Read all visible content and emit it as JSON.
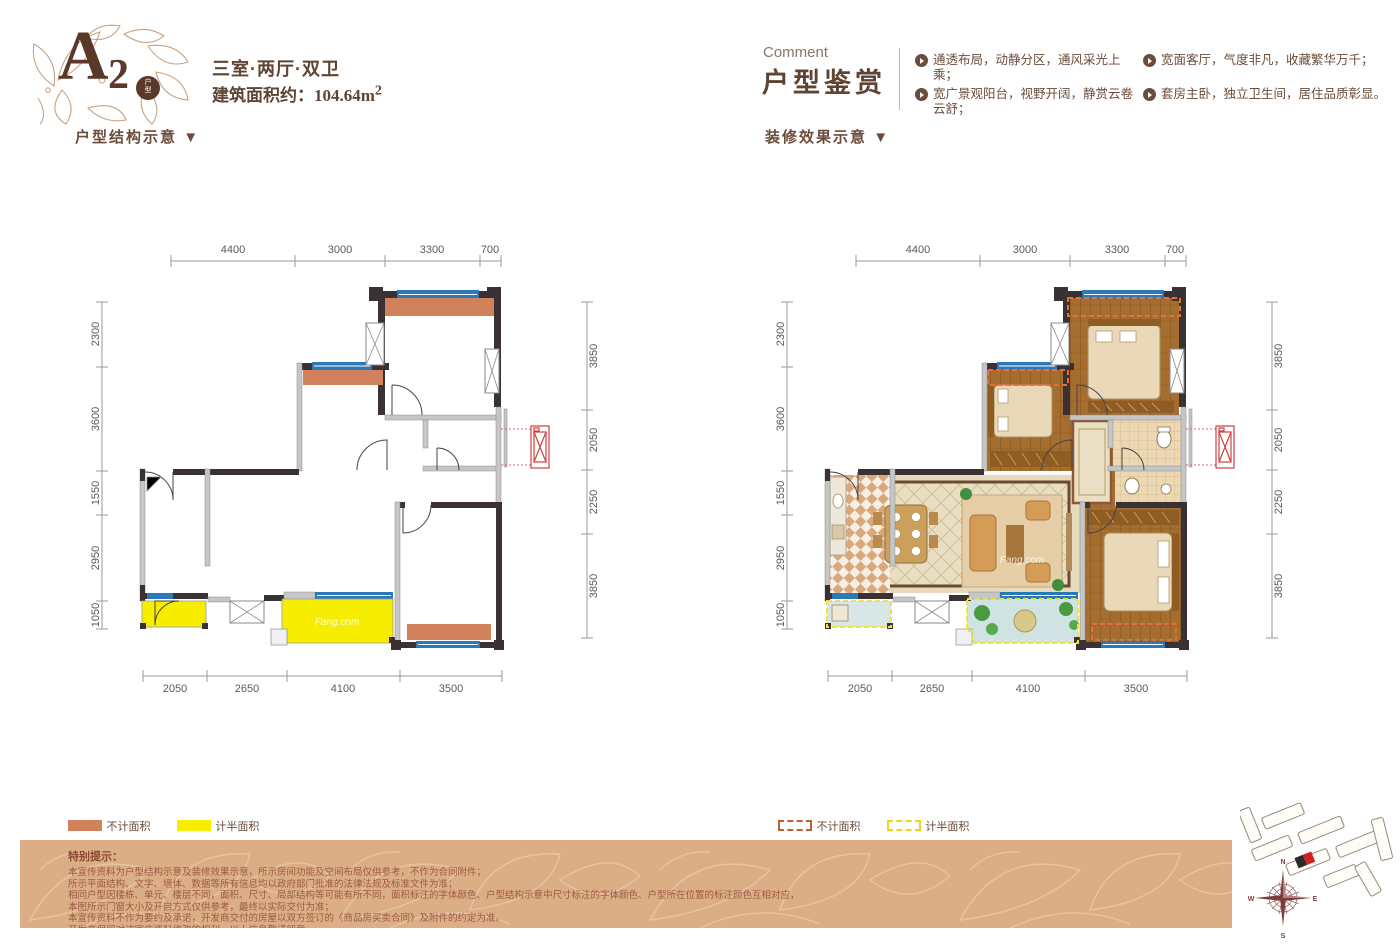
{
  "logo": {
    "letter": "A",
    "number": "2",
    "badge_top": "户",
    "badge_bottom": "型"
  },
  "header": {
    "unit_type": "三室·两厅·双卫",
    "area_label": "建筑面积约：",
    "area_value": "104.64m",
    "area_sup": "2",
    "struct_label": "户型结构示意",
    "deco_label": "装修效果示意",
    "arrow": "▼",
    "comment_en": "Comment",
    "comment_cn": "户型鉴赏",
    "bullets": [
      "通透布局，动静分区，通风采光上乘；",
      "宽面客厅，气度非凡，收藏繁华万千；",
      "宽广景观阳台，视野开阔，静赏云卷云舒；",
      "套房主卧，独立卫生间，居住品质彰显。"
    ]
  },
  "dims": {
    "top": [
      "4400",
      "3000",
      "3300",
      "700"
    ],
    "left": [
      "2300",
      "3600",
      "1550",
      "2950",
      "1050"
    ],
    "right": [
      "3850",
      "2050",
      "2250",
      "3850"
    ],
    "bottom": [
      "2050",
      "2650",
      "4100",
      "3500"
    ]
  },
  "legend": {
    "no_count": "不计面积",
    "half_count": "计半面积"
  },
  "watermark": "Fang.com",
  "disclaimer": {
    "title": "特别提示：",
    "lines": [
      "本宣传资料为户型结构示意及装修效果示意，所示房间功能及空间布局仅供参考，不作为合同附件；",
      "所示平面结构、文字、墙体、数据等所有信息均以政府部门批准的法律法规及标准文件为准；",
      "相同户型因楼栋、单元、楼层不同，面积、尺寸、局部结构等可能有所不同，面积标注的字体颜色、户型结构示意中尺寸标注的字体颜色、户型所在位置的标注颜色互相对应，",
      "本图所示门窗大小及开启方式仅供参考，最终以实际交付为准；",
      "本宣传资料不作为要约及承诺，开发商交付的房屋以双方签订的《商品房买卖合同》及附件的约定为准。",
      "开发商保留对该宣传资料修改的权利，以上信息敬请留意。"
    ]
  },
  "compass": {
    "n": "N",
    "e": "E",
    "s": "S",
    "w": "W"
  },
  "colors": {
    "accent_brown": "#6b4c3b",
    "bay_orange": "#d1815b",
    "balcony_yellow": "#f7ed00",
    "window_blue": "#2a7ab8",
    "wall_dark": "#3a3134",
    "band_tan": "#dcae86",
    "ac_red": "#d04040"
  }
}
